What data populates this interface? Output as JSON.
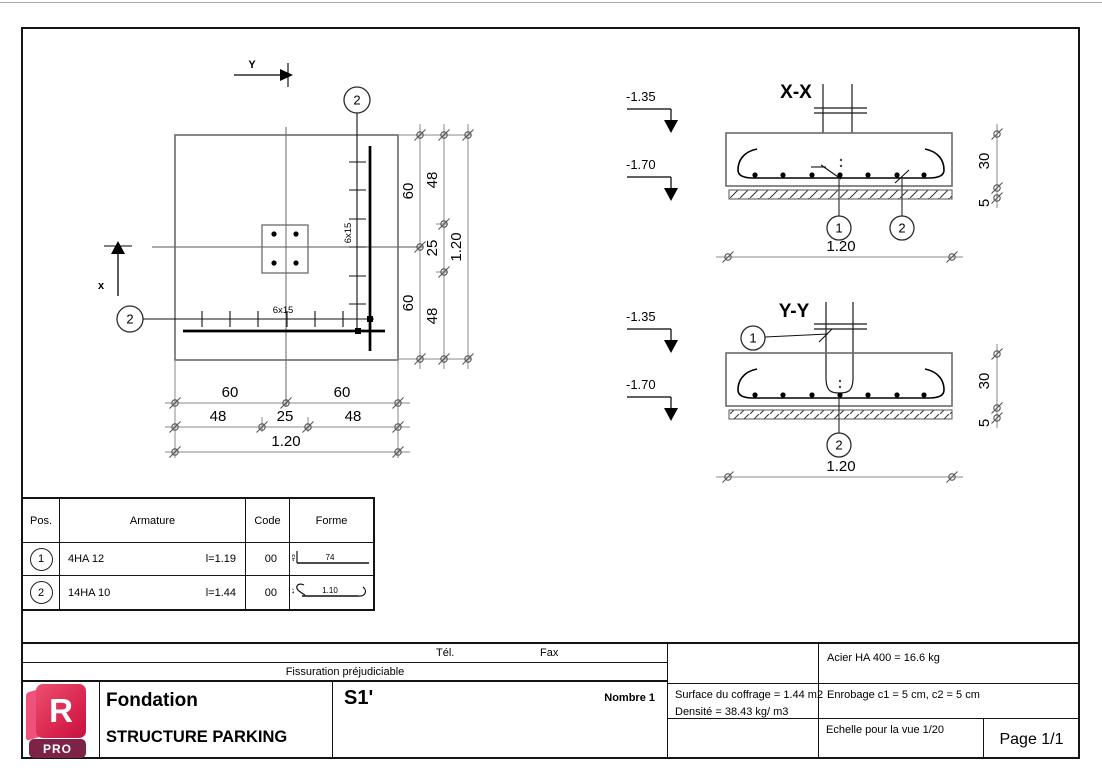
{
  "plan": {
    "axis_y": "Y",
    "axis_x": "x",
    "bubble_top": "2",
    "bubble_left": "2",
    "spacing_vertical": "6x15",
    "spacing_horizontal": "6x15",
    "dim_right_60_top": "60",
    "dim_right_48_top": "48",
    "dim_right_25": "25",
    "dim_right_60_bottom": "60",
    "dim_right_48_bottom": "48",
    "dim_right_total": "1.20",
    "dim_bottom_60_left": "60",
    "dim_bottom_60_right": "60",
    "dim_bottom_48_left": "48",
    "dim_bottom_25": "25",
    "dim_bottom_48_right": "48",
    "dim_bottom_total": "1.20"
  },
  "sections": {
    "xx": {
      "title": "X-X",
      "level_top": "-1.35",
      "level_bottom": "-1.70",
      "bubble_1": "1",
      "bubble_2": "2",
      "dim_width": "1.20",
      "dim_depth": "30",
      "dim_lean": "5"
    },
    "yy": {
      "title": "Y-Y",
      "level_top": "-1.35",
      "level_bottom": "-1.70",
      "bubble_1": "1",
      "bubble_2": "2",
      "dim_width": "1.20",
      "dim_depth": "30",
      "dim_lean": "5"
    }
  },
  "table": {
    "headers": {
      "pos": "Pos.",
      "armature": "Armature",
      "code": "Code",
      "forme": "Forme"
    },
    "rows": [
      {
        "pos": "1",
        "bars": "4HA 12",
        "length": "l=1.19",
        "code": "00",
        "shape_end": "45",
        "shape_main": "74"
      },
      {
        "pos": "2",
        "bars": "14HA 10",
        "length": "l=1.44",
        "code": "00",
        "shape_end": "17",
        "shape_main": "1.10"
      }
    ]
  },
  "titleblock": {
    "tel": "Tél.",
    "fax": "Fax",
    "fissuration": "Fissuration préjudiciable",
    "logo": {
      "letter": "R",
      "badge": "PRO"
    },
    "type": "Fondation",
    "project": "STRUCTURE PARKING",
    "element": "S1'",
    "nombre": "Nombre 1",
    "acier": "Acier HA 400 = 16.6 kg",
    "surface": "Surface du coffrage = 1.44 m2",
    "densite": "Densité = 38.43 kg/ m3",
    "enrobage": "Enrobage  c1 = 5 cm,  c2 = 5 cm",
    "echelle": "Echelle pour la vue 1/20",
    "page": "Page 1/1"
  },
  "colors": {
    "logo_front": "#d6204c",
    "logo_side": "#f0517b",
    "logo_pro": "#7d2347"
  }
}
